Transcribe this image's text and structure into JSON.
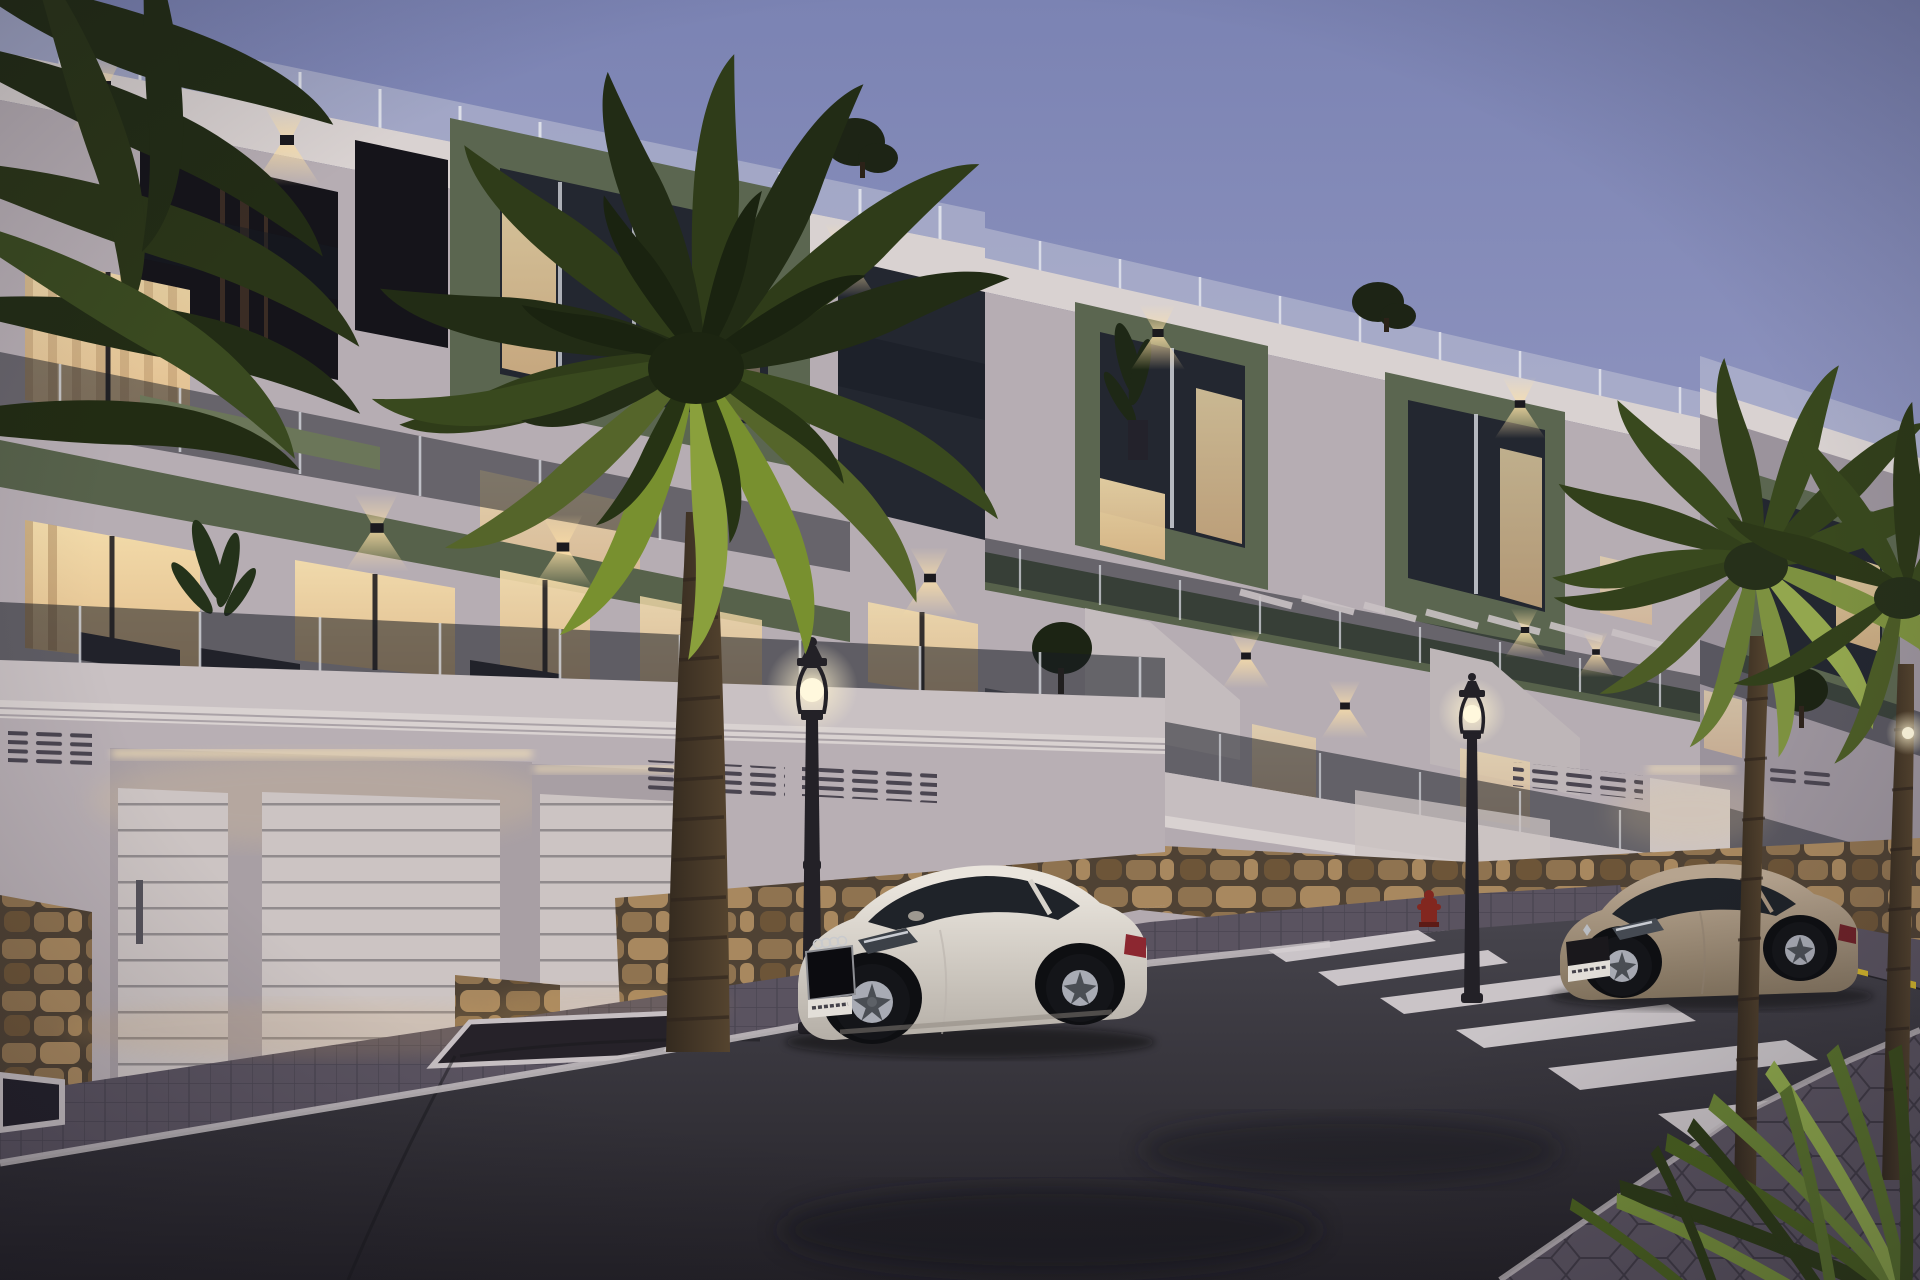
{
  "canvas": {
    "width": 1920,
    "height": 1280
  },
  "scene": {
    "setting": "Modern three-storey apartment complex street view at dusk (architectural render)",
    "time_of_day": "dusk",
    "buildings": [
      {
        "id": "left",
        "storeys": 3,
        "features": [
          "rooftop glass balustrade",
          "olive-green accent panel",
          "recessed lit balconies",
          "green balcony slab band",
          "smoked-glass railings",
          "warm lit interiors",
          "two garage doors with LED cove light",
          "pedestrian door",
          "ventilation grilles",
          "stone masonry plinth"
        ]
      },
      {
        "id": "middle",
        "storeys": 3,
        "features": [
          "rooftop glass balustrade",
          "two olive-green accent boxes",
          "wall downlights",
          "stepped terrace walls",
          "pergola slats",
          "lit garage recess",
          "ventilation grilles",
          "stone masonry plinth"
        ]
      },
      {
        "id": "right-far",
        "storeys": 3,
        "features": [
          "olive-green accent box",
          "glass balustrades",
          "stone plinth",
          "partially hidden by palms"
        ]
      }
    ],
    "vehicles": [
      {
        "id": "white-coupe",
        "body_style": "coupe",
        "color_name": "white",
        "facing": "left",
        "position": "parked curbside, foreground center"
      },
      {
        "id": "beige-coupe",
        "body_style": "coupe",
        "color_name": "champagne-beige",
        "facing": "left",
        "position": "parked beyond zebra crossing, right"
      }
    ],
    "street": {
      "lamps_lit": 3,
      "fire_hydrant": 1,
      "crosswalk_stripes": 7,
      "curb_marking": "yellow-black dashes",
      "road_marking": "white edge line",
      "sidewalk": "paver sidewalk with tree pit and raised planter",
      "foreground_pavement": "hexagonal pavers"
    },
    "vegetation": {
      "foreground_palm": 1,
      "right_palms": 2,
      "left_edge_palm_fronds": true,
      "corner_palm_leaves_bottom_right": true,
      "rooftop_trees": 2,
      "terrace_plants": 3,
      "balcony_planters": 3
    }
  },
  "colors": {
    "sky_top": "#7b83b3",
    "sky_mid": "#9297c1",
    "sky_low": "#aeaac9",
    "sky_horizon": "#c9bcce",
    "wall_light": "#cfc8c9",
    "wall_mid": "#b6adb3",
    "wall_shadow": "#9b939c",
    "wall_dark": "#847c86",
    "cornice": "#d9d2d1",
    "green_accent": "#5b6650",
    "green_accent_dark": "#454e3b",
    "green_slab": "#57624b",
    "glass_dark": "#232730",
    "balustrade_glass": "#171b23",
    "balustrade_post": "#d6d8de",
    "window_glow": "#e2bd8c",
    "window_bright": "#f3dcab",
    "curtain": "#d8bf9a",
    "interior_dark": "#15141a",
    "led_glow": "#ffe9b8",
    "lamp_glow": "#fff3cf",
    "lamp_post": "#232127",
    "garage_door": "#ccc4c3",
    "grille_slat": "#4a4550",
    "stone": "#8f7350",
    "stone_light": "#a8885f",
    "stone_dark": "#6d5538",
    "stone_grout": "#4f4234",
    "road": "#47454d",
    "road_dark": "#232127",
    "lane_line": "#c6bfc2",
    "crosswalk_stripe": "#d6d0d3",
    "hazard_yellow": "#d2b52c",
    "hazard_dark": "#26242a",
    "sidewalk": "#5a5360",
    "curb": "#c1babd",
    "palm_dark": "#222c15",
    "palm_mid": "#39491e",
    "palm_lit": "#78902f",
    "palm_bright": "#a3b648",
    "trunk": "#55442f",
    "trunk_dark": "#342a1f",
    "car_white": "#eae5dd",
    "car_white_shadow": "#b5afa7",
    "car_beige": "#b6a48f",
    "car_beige_shadow": "#82735e",
    "car_glass": "#1f2329",
    "wheel": "#141519",
    "rim": "#a8abb4",
    "taillight": "#8c2730",
    "hydrant": "#82271f",
    "plate": "#e2ded8",
    "shadow": "#0b0a0f"
  }
}
